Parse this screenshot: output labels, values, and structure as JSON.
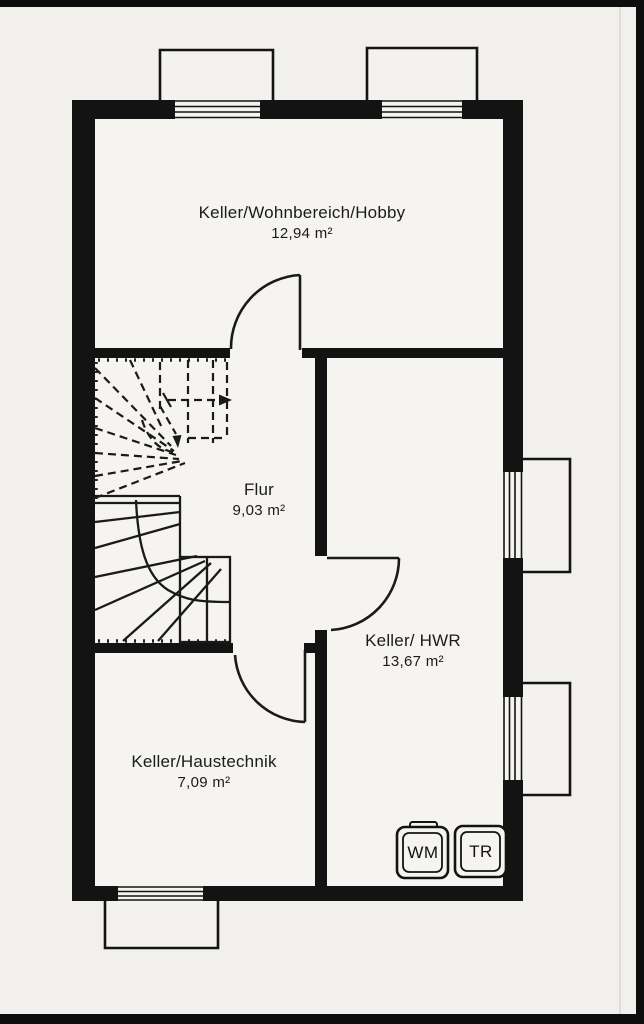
{
  "document": {
    "kind": "floor-plan-scan",
    "floor": "Keller"
  },
  "rooms": {
    "hobby": {
      "name": "Keller/Wohnbereich/Hobby",
      "area": "12,94 m²"
    },
    "flur": {
      "name": "Flur",
      "area": "9,03 m²"
    },
    "hwr": {
      "name": "Keller/ HWR",
      "area": "13,67 m²"
    },
    "haustechnik": {
      "name": "Keller/Haustechnik",
      "area": "7,09 m²"
    }
  },
  "appliances": {
    "washer": "WM",
    "dryer": "TR"
  },
  "colors": {
    "paper": "#f1f0ec",
    "wall": "#131313",
    "line": "#1a1a1a",
    "crease": "#deddda"
  }
}
